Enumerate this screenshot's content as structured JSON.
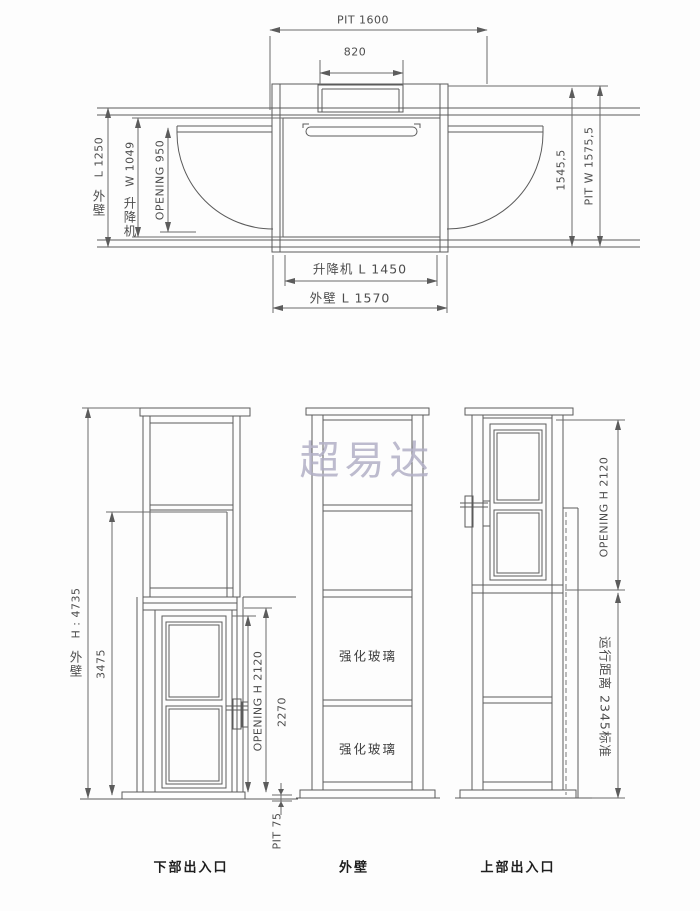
{
  "watermark": "超易达",
  "plan": {
    "dim_pit_length": "PIT 1600",
    "dim_top_opening": "820",
    "dim_outer_depth_num": "L 1250",
    "dim_outer_depth_cjk": [
      "外",
      "壁"
    ],
    "dim_car_width_num": "W 1049",
    "dim_car_width_cjk": [
      "升",
      "降",
      "机"
    ],
    "dim_opening_width": "OPENING 950",
    "dim_inner_width": "1545,5",
    "dim_pit_width": "PIT W 1575,5",
    "dim_car_length": "升降机 L 1450",
    "dim_outer_length": "外壁 L 1570"
  },
  "elevations": {
    "left": {
      "caption": "下部出入口",
      "dim_total_height_num": "H : 4735",
      "dim_total_height_cjk": [
        "外",
        "壁"
      ],
      "dim_rail_height": "3475",
      "dim_opening_height": "OPENING H 2120",
      "dim_door_height": "2270",
      "dim_pit_depth": "PIT 75"
    },
    "middle": {
      "caption": "外壁",
      "panel_label_1": "强化玻璃",
      "panel_label_2": "强化玻璃"
    },
    "right": {
      "caption": "上部出入口",
      "dim_opening_height": "OPENING H 2120",
      "dim_travel": "运行距离 2345标准"
    }
  }
}
